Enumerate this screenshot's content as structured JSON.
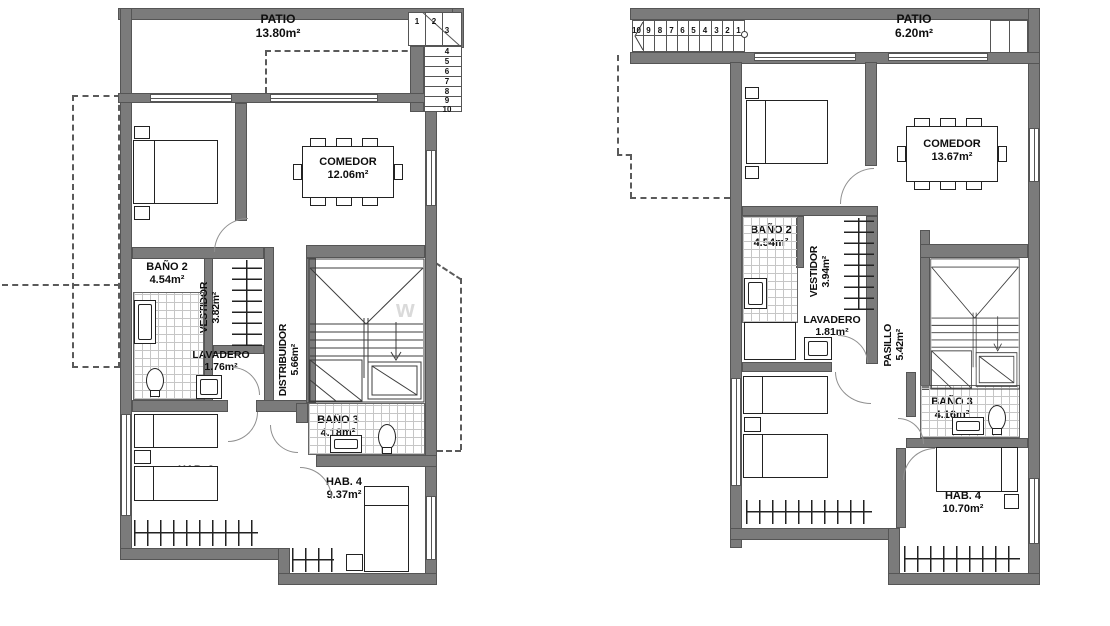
{
  "watermark": "w",
  "plan_left": {
    "patio": {
      "name": "PATIO",
      "area": "13.80m²"
    },
    "hab2": {
      "name": "HAB. 2",
      "area": "10.67m²"
    },
    "comedor": {
      "name": "COMEDOR",
      "area": "12.06m²"
    },
    "bano2": {
      "name": "BAÑO 2",
      "area": "4.54m²"
    },
    "vestidor": {
      "name": "VESTIDOR",
      "area": "3.82m²"
    },
    "lavadero": {
      "name": "LAVADERO",
      "area": "1.76m²"
    },
    "distribuidor": {
      "name": "DISTRIBUIDOR",
      "area": "5.66m²"
    },
    "hab3": {
      "name": "HAB. 3",
      "area": "10.71m²"
    },
    "bano3": {
      "name": "BAÑO 3",
      "area": "4.18m²"
    },
    "hab4": {
      "name": "HAB. 4",
      "area": "9.37m²"
    },
    "stairs": [
      "1",
      "2",
      "3",
      "4",
      "5",
      "6",
      "7",
      "8",
      "9",
      "10"
    ]
  },
  "plan_right": {
    "patio": {
      "name": "PATIO",
      "area": "6.20m²"
    },
    "hab2": {
      "name": "HAB. 2",
      "area": "11.16m²"
    },
    "comedor": {
      "name": "COMEDOR",
      "area": "13.67m²"
    },
    "bano2": {
      "name": "BAÑO 2",
      "area": "4.54m²"
    },
    "vestidor": {
      "name": "VESTIDOR",
      "area": "3.94m²"
    },
    "lavadero": {
      "name": "LAVADERO",
      "area": "1.81m²"
    },
    "pasillo": {
      "name": "PASILLO",
      "area": "5.42m²"
    },
    "hab3": {
      "name": "HAB. 3",
      "area": "12.12m²"
    },
    "bano3": {
      "name": "BAÑO 3",
      "area": "4.16m²"
    },
    "hab4": {
      "name": "HAB. 4",
      "area": "10.70m²"
    },
    "stairs": [
      "10",
      "9",
      "8",
      "7",
      "6",
      "5",
      "4",
      "3",
      "2",
      "1"
    ]
  }
}
